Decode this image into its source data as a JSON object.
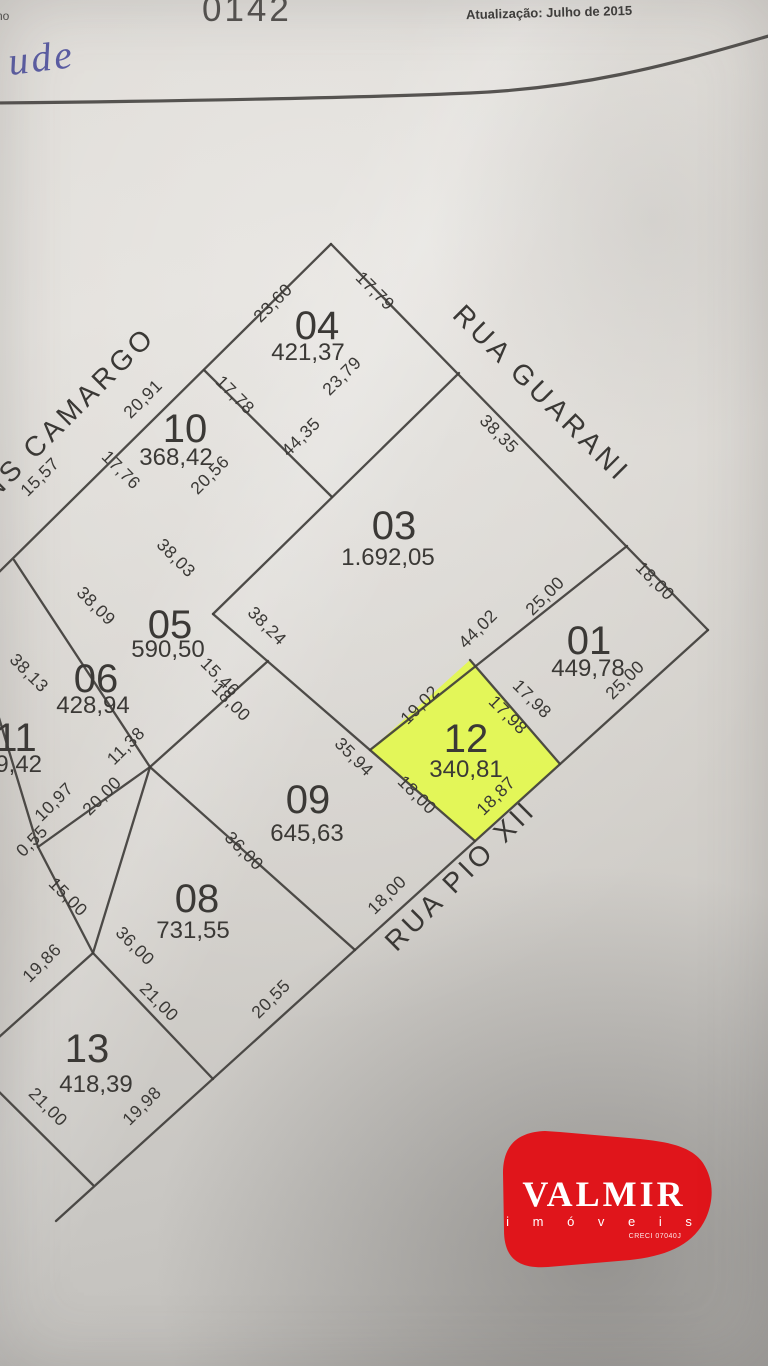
{
  "header": {
    "side_text": "no",
    "code": "0142",
    "updated": "Atualização: Julho de 2015",
    "handwritten_note": "ude"
  },
  "map": {
    "streets": [
      {
        "name": "RUA GUARANI"
      },
      {
        "name": "RUA PIO XII"
      },
      {
        "name": "NS CAMARGO"
      }
    ],
    "highlight_color": "#e4f94e",
    "line_color": "#403e3b",
    "lots": [
      {
        "number": "04",
        "area": "421,37"
      },
      {
        "number": "10",
        "area": "368,42"
      },
      {
        "number": "03",
        "area": "1.692,05"
      },
      {
        "number": "01",
        "area": "449,78"
      },
      {
        "number": "12",
        "area": "340,81",
        "highlighted": true
      },
      {
        "number": "05",
        "area": "590,50"
      },
      {
        "number": "06",
        "area": "428,94"
      },
      {
        "number": "11",
        "area": "09,42"
      },
      {
        "number": "09",
        "area": "645,63"
      },
      {
        "number": "08",
        "area": "731,55"
      },
      {
        "number": "13",
        "area": "418,39"
      }
    ],
    "dims": [
      {
        "v": "23,60"
      },
      {
        "v": "17,79"
      },
      {
        "v": "23,79"
      },
      {
        "v": "17,78"
      },
      {
        "v": "20,91"
      },
      {
        "v": "20,56"
      },
      {
        "v": "17,76"
      },
      {
        "v": "15,57"
      },
      {
        "v": "44,35"
      },
      {
        "v": "38,35"
      },
      {
        "v": "38,03"
      },
      {
        "v": "38,09"
      },
      {
        "v": "38,13"
      },
      {
        "v": "38,24"
      },
      {
        "v": "44,02"
      },
      {
        "v": "25,00"
      },
      {
        "v": "18,00"
      },
      {
        "v": "25,00"
      },
      {
        "v": "17,98"
      },
      {
        "v": "17,98"
      },
      {
        "v": "19,02"
      },
      {
        "v": "18,87"
      },
      {
        "v": "18,00"
      },
      {
        "v": "35,94"
      },
      {
        "v": "18,00"
      },
      {
        "v": "15,46"
      },
      {
        "v": "18,00"
      },
      {
        "v": "11,38"
      },
      {
        "v": "10,97"
      },
      {
        "v": "20,00"
      },
      {
        "v": "0,55"
      },
      {
        "v": "15,00"
      },
      {
        "v": "36,00"
      },
      {
        "v": "36,00"
      },
      {
        "v": "21,00"
      },
      {
        "v": "21,00"
      },
      {
        "v": "19,86"
      },
      {
        "v": "19,98"
      },
      {
        "v": "20,55"
      }
    ]
  },
  "logo": {
    "name": "VALMIR",
    "tagline": "i m ó v e i s",
    "license": "CRECI 07040J",
    "color": "#e0151b"
  }
}
